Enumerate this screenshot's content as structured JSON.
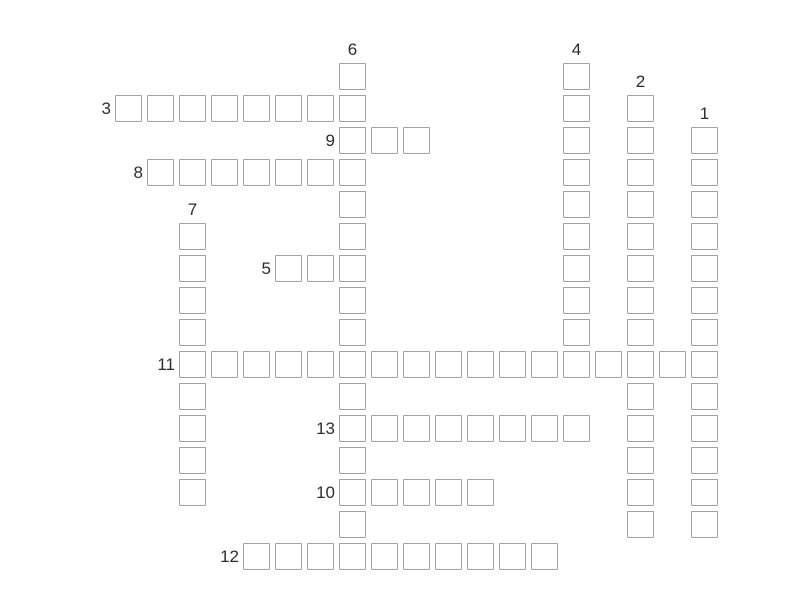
{
  "app": {
    "name": "crossword-puzzle",
    "description": "Empty crossword grid with numbered across and down clues"
  },
  "colors": {
    "background": "#ffffff",
    "cell_border": "#a2a2a2",
    "cell_fill": "#ffffff",
    "label": "#2d2d2d"
  },
  "puzzle": {
    "clue_numbers_visible": [
      "1",
      "2",
      "3",
      "4",
      "5",
      "6",
      "7",
      "8",
      "9",
      "10",
      "11",
      "12",
      "13"
    ],
    "words": [
      {
        "number": "1",
        "direction": "down",
        "col": 18,
        "row": 2,
        "length": 13
      },
      {
        "number": "2",
        "direction": "down",
        "col": 16,
        "row": 1,
        "length": 14
      },
      {
        "number": "3",
        "direction": "across",
        "col": 0,
        "row": 1,
        "length": 8
      },
      {
        "number": "4",
        "direction": "down",
        "col": 14,
        "row": 0,
        "length": 10
      },
      {
        "number": "5",
        "direction": "across",
        "col": 5,
        "row": 6,
        "length": 3
      },
      {
        "number": "6",
        "direction": "down",
        "col": 7,
        "row": 0,
        "length": 16
      },
      {
        "number": "7",
        "direction": "down",
        "col": 2,
        "row": 5,
        "length": 9
      },
      {
        "number": "8",
        "direction": "across",
        "col": 1,
        "row": 3,
        "length": 7
      },
      {
        "number": "9",
        "direction": "across",
        "col": 7,
        "row": 2,
        "length": 3
      },
      {
        "number": "10",
        "direction": "across",
        "col": 7,
        "row": 13,
        "length": 5
      },
      {
        "number": "11",
        "direction": "across",
        "col": 2,
        "row": 9,
        "length": 17
      },
      {
        "number": "12",
        "direction": "across",
        "col": 4,
        "row": 15,
        "length": 10
      },
      {
        "number": "13",
        "direction": "across",
        "col": 7,
        "row": 11,
        "length": 8
      }
    ]
  }
}
